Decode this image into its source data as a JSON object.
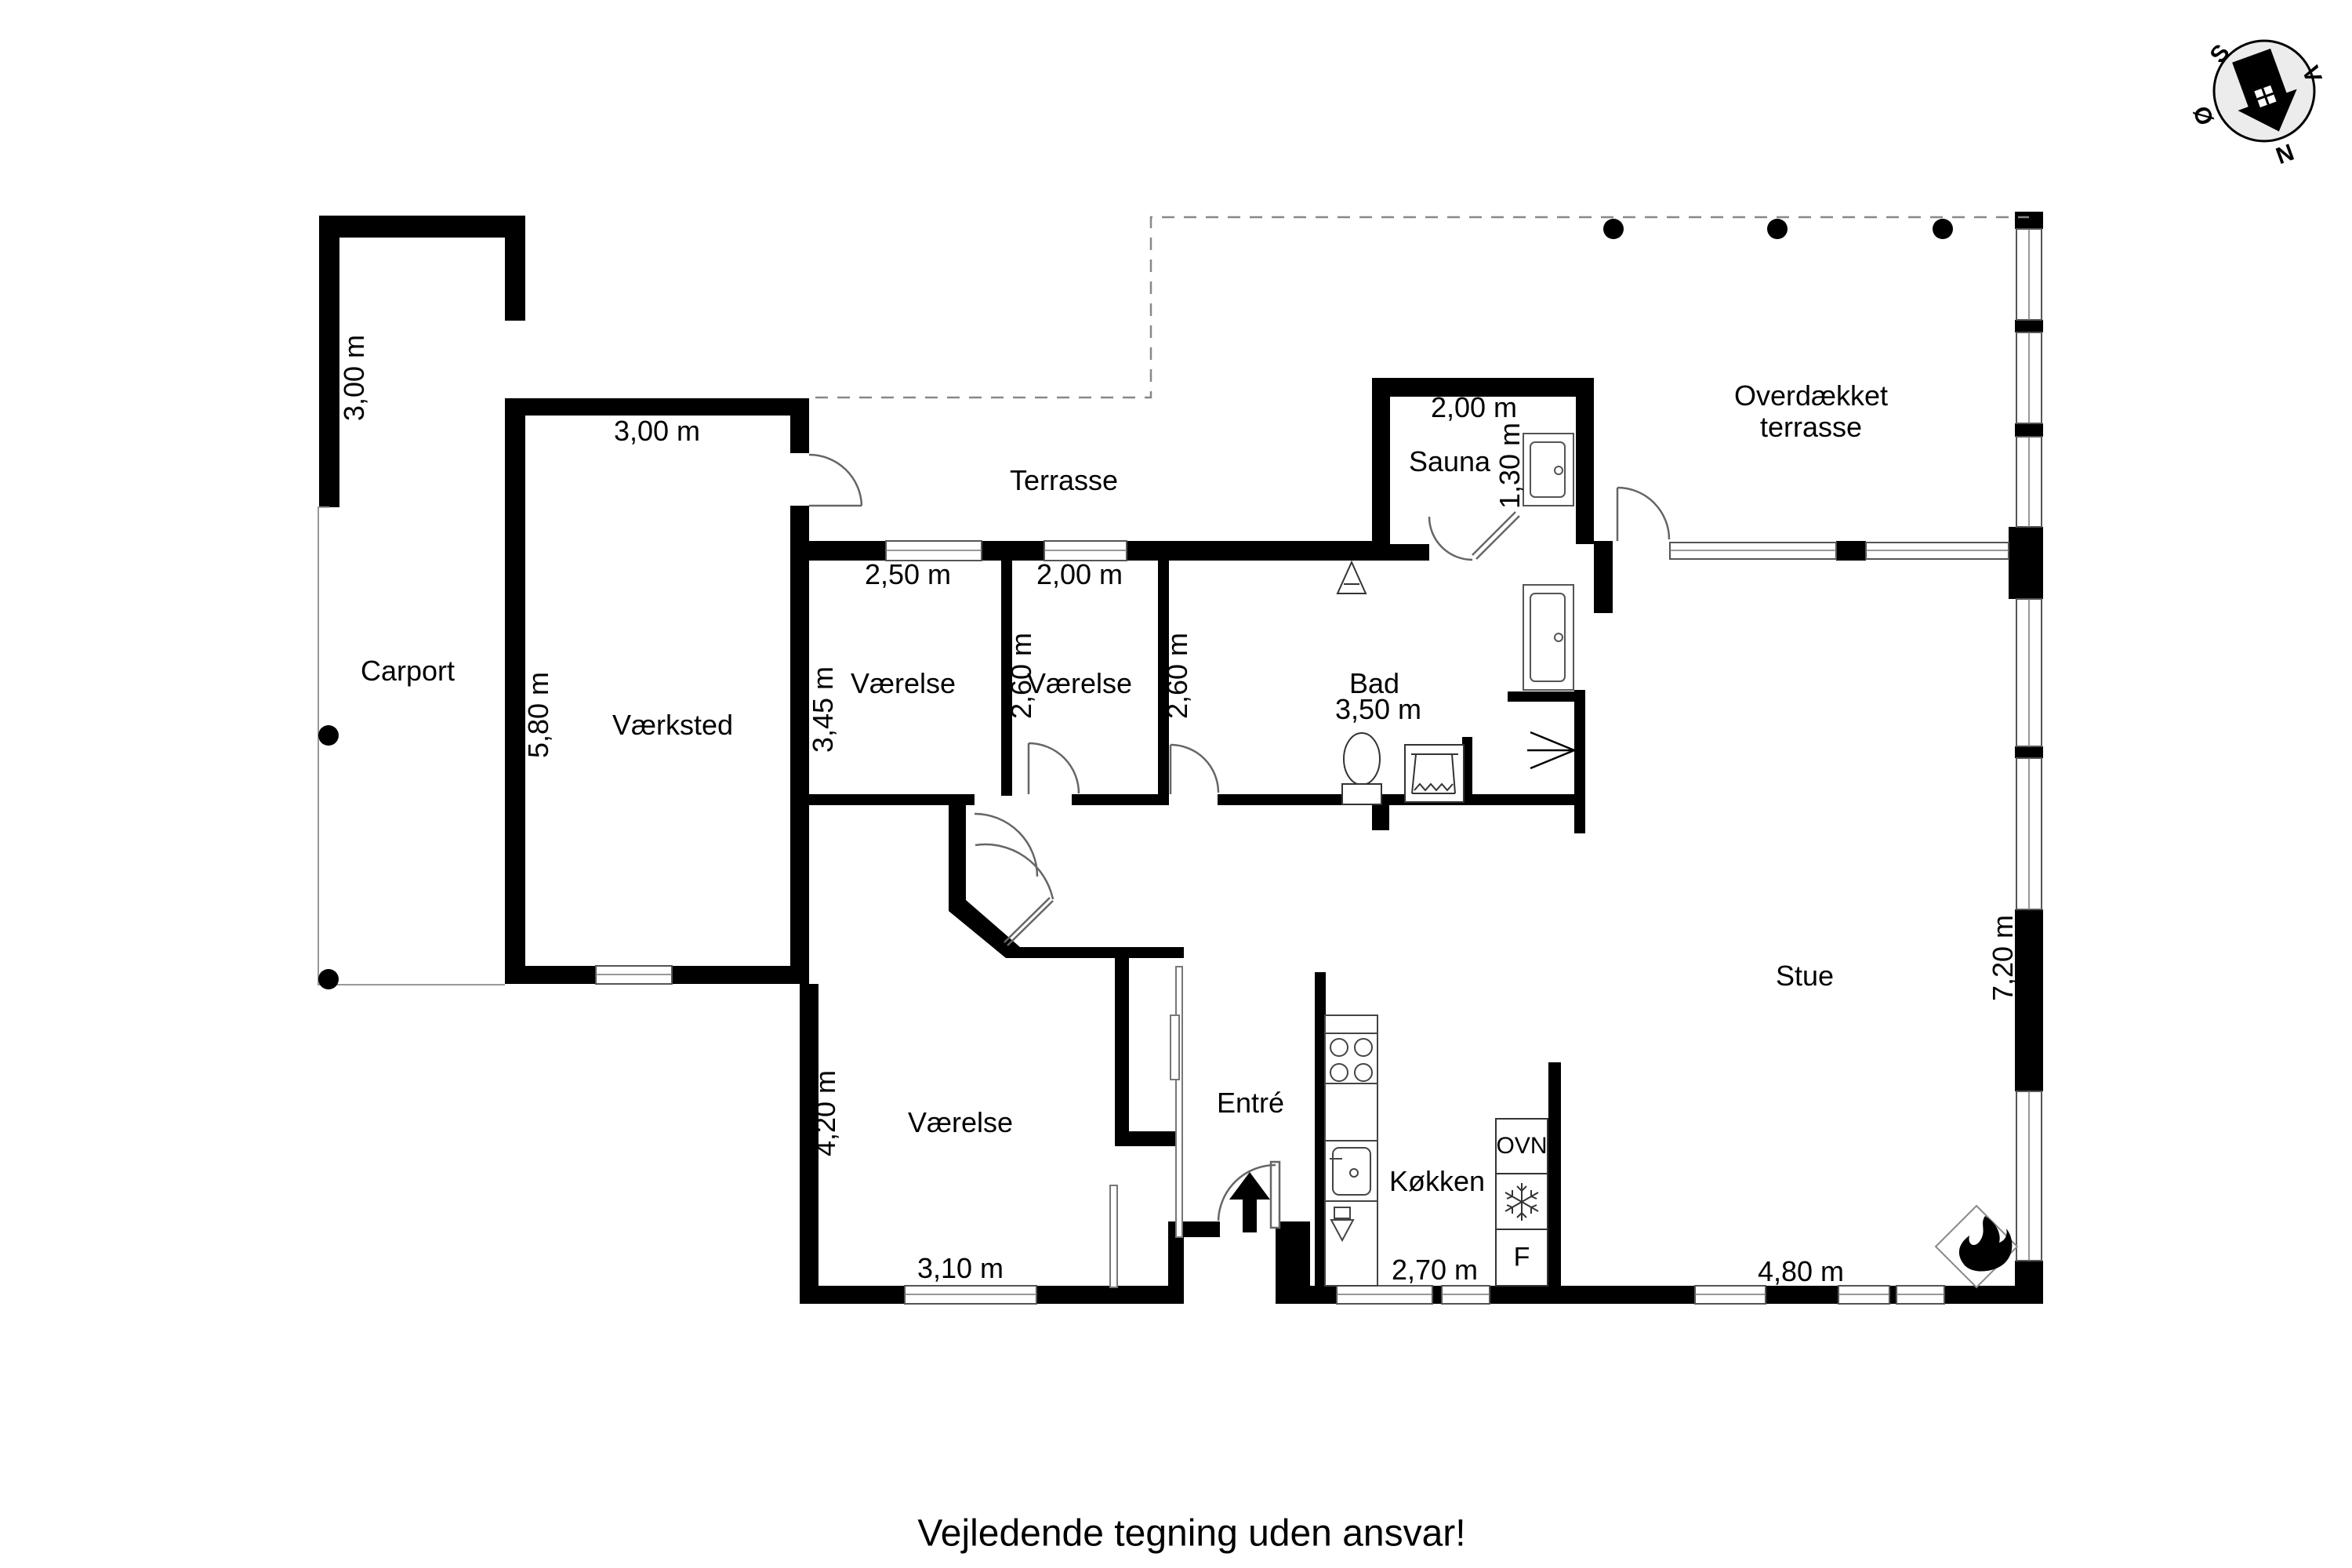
{
  "plan": {
    "title": "Floor plan",
    "footer": "Vejledende tegning uden ansvar!",
    "rooms": {
      "carport": {
        "label": "Carport",
        "side_dim": "3,00 m"
      },
      "vaerksted": {
        "label": "Værksted",
        "width": "3,00 m",
        "height": "5,80 m"
      },
      "terrasse": {
        "label": "Terrasse"
      },
      "overdaekket": {
        "line1": "Overdækket",
        "line2": "terrasse"
      },
      "vaerelse1": {
        "label": "Værelse",
        "width": "2,50 m",
        "height": "3,45 m"
      },
      "vaerelse2": {
        "label": "Værelse",
        "width": "2,00 m",
        "height_left": "2,60 m",
        "height_right": "2,60 m"
      },
      "sauna": {
        "label": "Sauna",
        "width": "2,00 m",
        "depth": "1,30 m"
      },
      "bad": {
        "label": "Bad",
        "width": "3,50 m"
      },
      "stue": {
        "label": "Stue",
        "height": "7,20 m",
        "width": "4,80 m"
      },
      "vaerelse3": {
        "label": "Værelse",
        "width": "3,10 m",
        "height": "4,20 m"
      },
      "entre": {
        "label": "Entré"
      },
      "koekken": {
        "label": "Køkken",
        "width": "2,70 m"
      }
    },
    "appliances": {
      "oven": "OVN",
      "fridge": "F"
    },
    "compass": {
      "n": "N",
      "s": "S",
      "v": "V",
      "oe": "Ø"
    },
    "colors": {
      "wall": "#000000",
      "outline": "#555555",
      "thin": "#999999",
      "compass_fill": "#ececec"
    }
  }
}
